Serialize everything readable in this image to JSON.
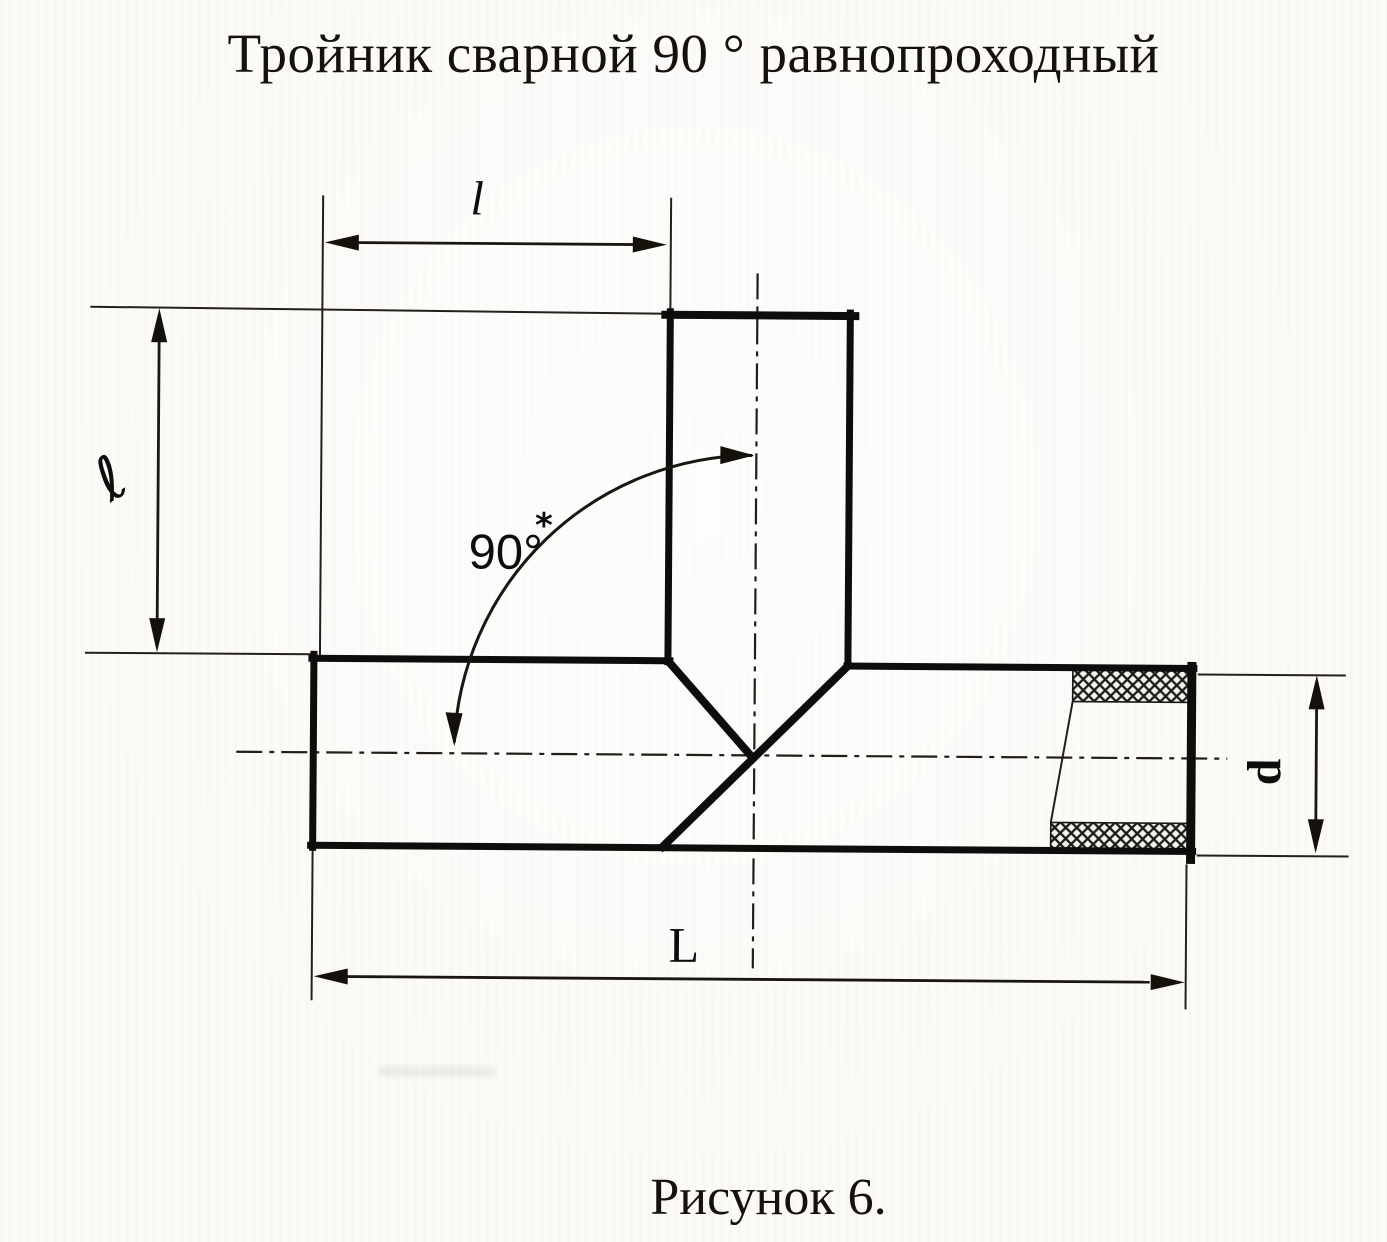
{
  "title": "Тройник сварной 90 ° равнопроходный",
  "caption": "Рисунок 6.",
  "dimensions": {
    "branch_length_top": "l",
    "branch_height_left": "ℓ",
    "angle": "90°",
    "angle_footnote": "*",
    "overall_length": "L",
    "diameter": "d"
  },
  "colors": {
    "ink": "#14110e",
    "paper": "#fbfaf7"
  }
}
